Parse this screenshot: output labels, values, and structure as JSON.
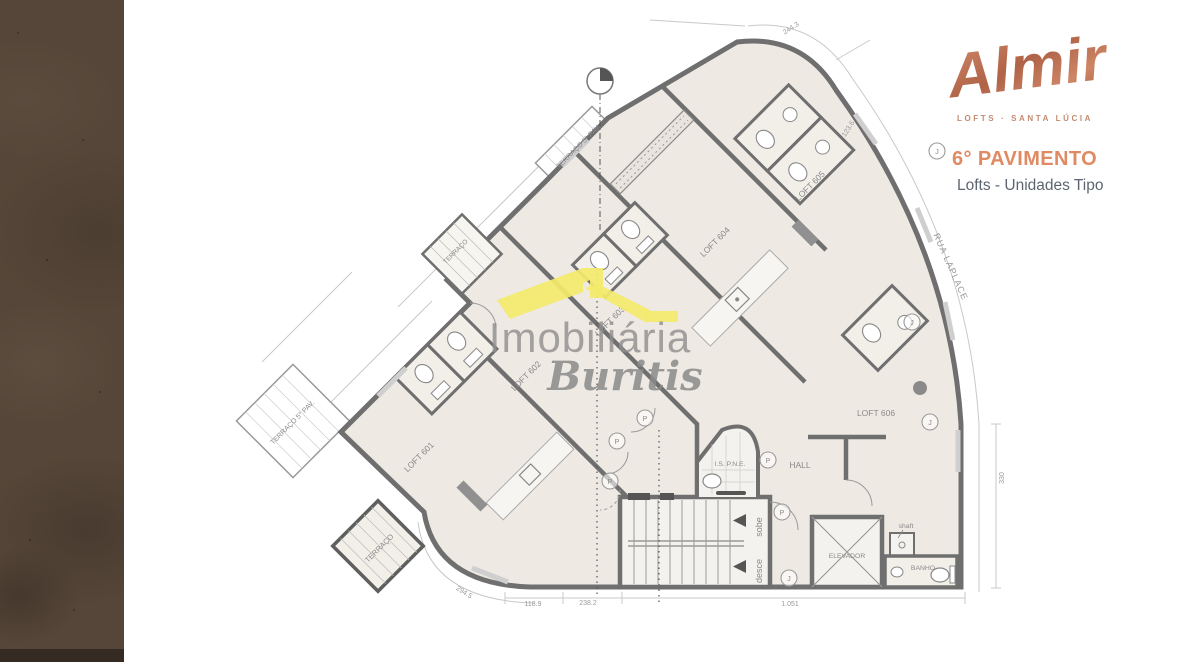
{
  "brand": {
    "logo": "Almir",
    "tagline": "LOFTS · SANTA LÚCIA",
    "floor_title": "6° PAVIMENTO",
    "floor_subtitle": "Lofts - Unidades Tipo"
  },
  "watermark": {
    "line1": "Imobiliária",
    "line2": "Buritis"
  },
  "plan": {
    "street": "RUA LAPLACE",
    "rooms": [
      {
        "label": "LOFT 601"
      },
      {
        "label": "LOFT 602"
      },
      {
        "label": "LOFT 603"
      },
      {
        "label": "LOFT 604"
      },
      {
        "label": "LOFT 605"
      },
      {
        "label": "LOFT 606"
      },
      {
        "label": "HALL"
      },
      {
        "label": "I.S. P.N.E."
      },
      {
        "label": "ELEVADOR"
      },
      {
        "label": "BANHO"
      },
      {
        "label": "shaft"
      },
      {
        "label": "sobe"
      },
      {
        "label": "desce"
      }
    ],
    "terraces": [
      {
        "label": "TERRAÇO 5° PAV."
      },
      {
        "label": "TERRAÇO 5° PAV."
      },
      {
        "label": "TERRAÇO"
      },
      {
        "label": "TERRAÇO"
      }
    ],
    "dims": [
      {
        "label": "294.5"
      },
      {
        "label": "118.9"
      },
      {
        "label": "238.2"
      },
      {
        "label": "1.051"
      },
      {
        "label": "330"
      },
      {
        "label": "244.3"
      },
      {
        "label": "123.6"
      }
    ],
    "markers": [
      {
        "letter": "P"
      },
      {
        "letter": "P"
      },
      {
        "letter": "P"
      },
      {
        "letter": "P"
      },
      {
        "letter": "P"
      },
      {
        "letter": "J"
      },
      {
        "letter": "J"
      },
      {
        "letter": "J"
      },
      {
        "letter": "J"
      }
    ]
  },
  "colors": {
    "accent_copper": "#E08A63",
    "logo_copper": "#C07A5C",
    "subtitle_gray": "#5D6670",
    "wall_gray": "#6F6F6F",
    "room_fill": "#EFE9E3",
    "watermark_yellow": "#F3EA6B",
    "watermark_gray": "#8F8F8F",
    "strip_brown": "#564639"
  }
}
